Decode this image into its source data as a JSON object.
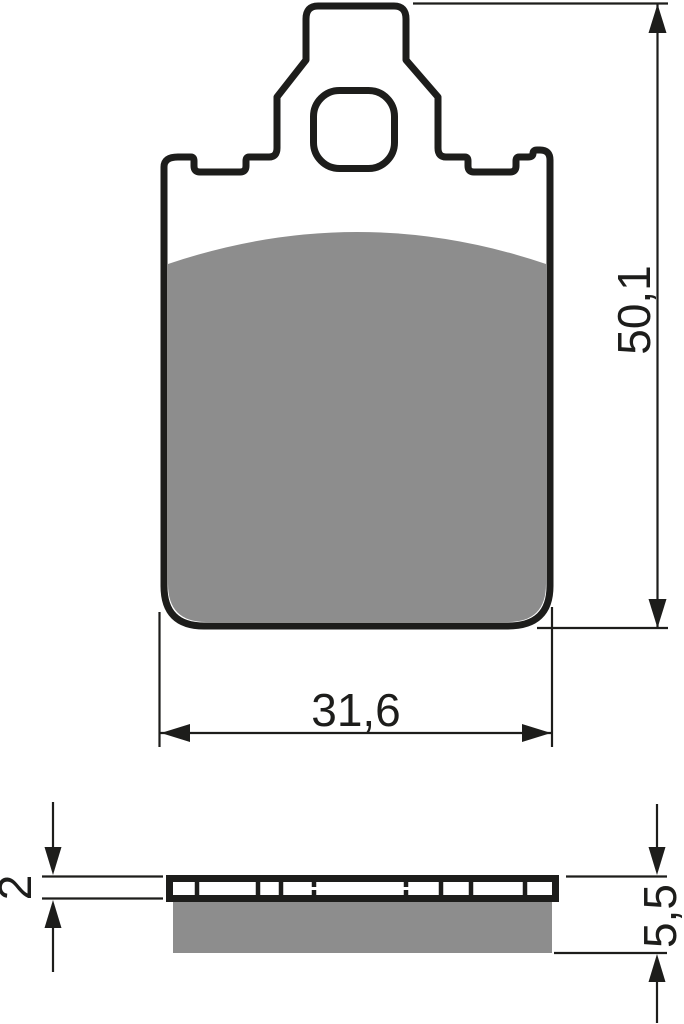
{
  "drawing": {
    "dimensions": {
      "height": "50,1",
      "width": "31,6",
      "plate_thickness": "2",
      "total_thickness": "5,5"
    },
    "colors": {
      "line": "#1d1d1b",
      "friction": "#8d8d8d",
      "background": "#ffffff"
    }
  }
}
